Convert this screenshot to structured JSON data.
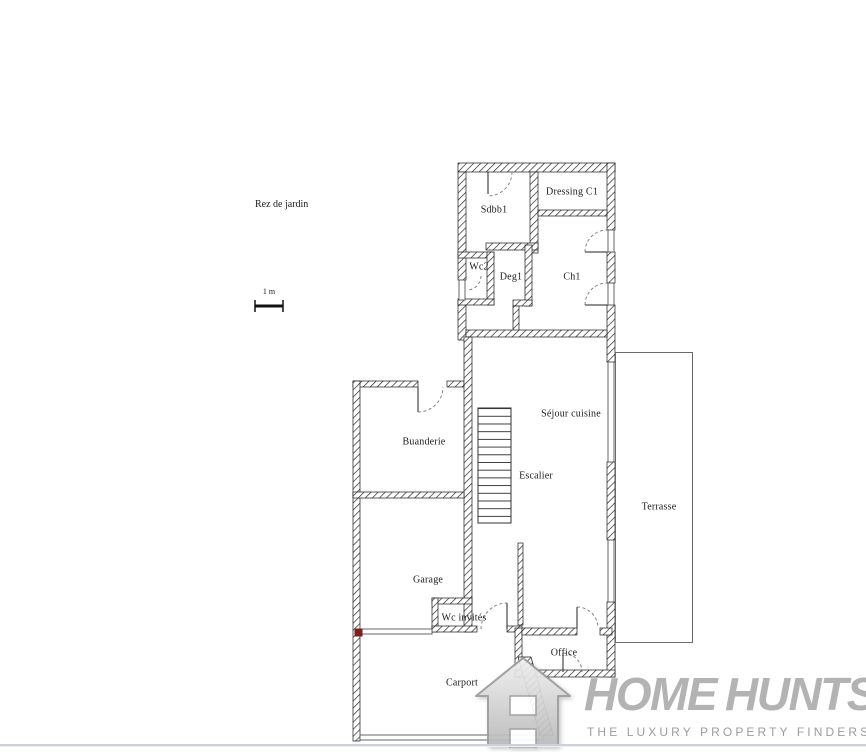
{
  "plan": {
    "title": "Rez de jardin",
    "scale_label": "1 m",
    "rooms": [
      {
        "label": "Sdbb1"
      },
      {
        "label": "Dressing C1"
      },
      {
        "label": "Wc2"
      },
      {
        "label": "Deg1"
      },
      {
        "label": "Ch1"
      },
      {
        "label": "Séjour cuisine"
      },
      {
        "label": "Escalier"
      },
      {
        "label": "Buanderie"
      },
      {
        "label": "Garage"
      },
      {
        "label": "Wc invités"
      },
      {
        "label": "Office"
      },
      {
        "label": "Carport"
      },
      {
        "label": "Terrasse"
      }
    ],
    "marker_color": "#7b1f1f",
    "wall_line_color": "#1a1a1a"
  },
  "logo": {
    "word1": "HOME",
    "word2": "HUNTS",
    "tagline": "THE LUXURY PROPERTY FINDERS",
    "icon": "house-h-icon",
    "text_color": "#b3b3b3",
    "tagline_color": "#9c9c9c"
  }
}
